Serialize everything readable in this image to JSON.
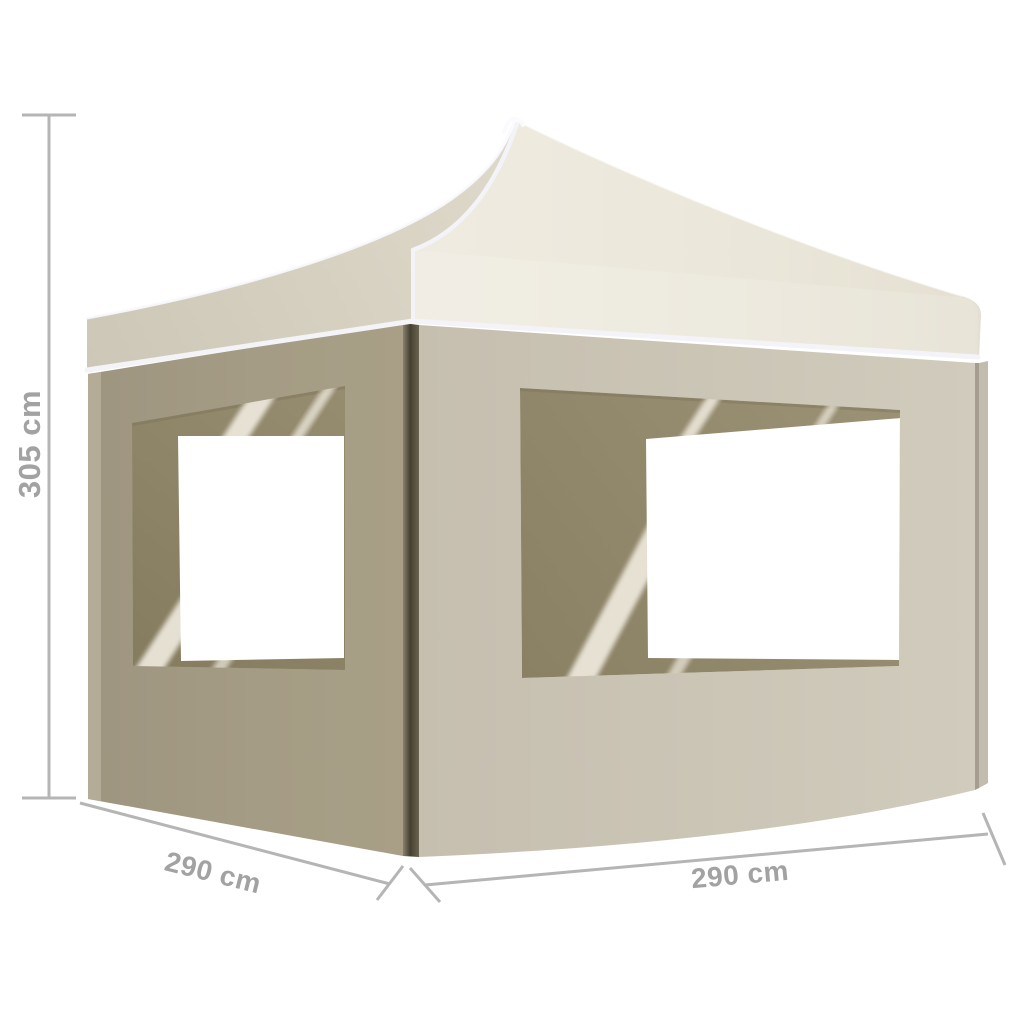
{
  "canvas": {
    "width": 1024,
    "height": 1024,
    "background": "#ffffff"
  },
  "illustration": {
    "description": "Cream pop-up party tent with peaked canopy, side walls and large windows, annotated with measurement lines"
  },
  "dimensions": {
    "height_label": "305 cm",
    "depth_label": "290 cm",
    "width_label": "290 cm"
  },
  "colors": {
    "background": "#ffffff",
    "canopy_light": "#ece8dc",
    "canopy_shaded": "#d2ccbc",
    "valance_piping": "#f3f3f8",
    "left_wall": "#a39a83",
    "front_wall": "#cbc4b5",
    "corner_post_shadow": "#45402e",
    "window_mesh_dark": "#8a8064",
    "window_streak": "#f0ebdf",
    "window_pane": "#ffffff",
    "dimension_line": "#b5b5b5",
    "dimension_text": "#a2a2a2"
  }
}
